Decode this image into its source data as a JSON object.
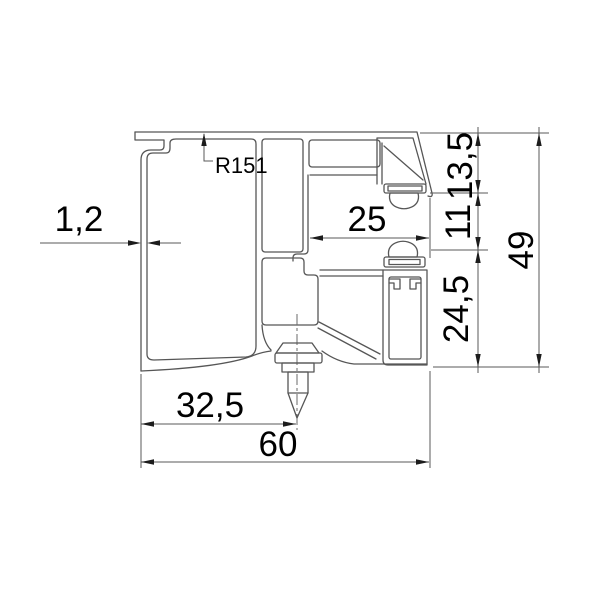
{
  "drawing": {
    "type": "technical-profile-cross-section",
    "dimension_labels": {
      "wall_thickness": "1,2",
      "radius_callout": "R151",
      "groove_width": "25",
      "seal_zone_height": "13,5",
      "gap_height": "11",
      "lower_body_height": "24,5",
      "total_height": "49",
      "screw_offset": "32,5",
      "total_width": "60"
    },
    "colors": {
      "line": "#565656",
      "text": "#000000",
      "background": "#ffffff"
    }
  }
}
